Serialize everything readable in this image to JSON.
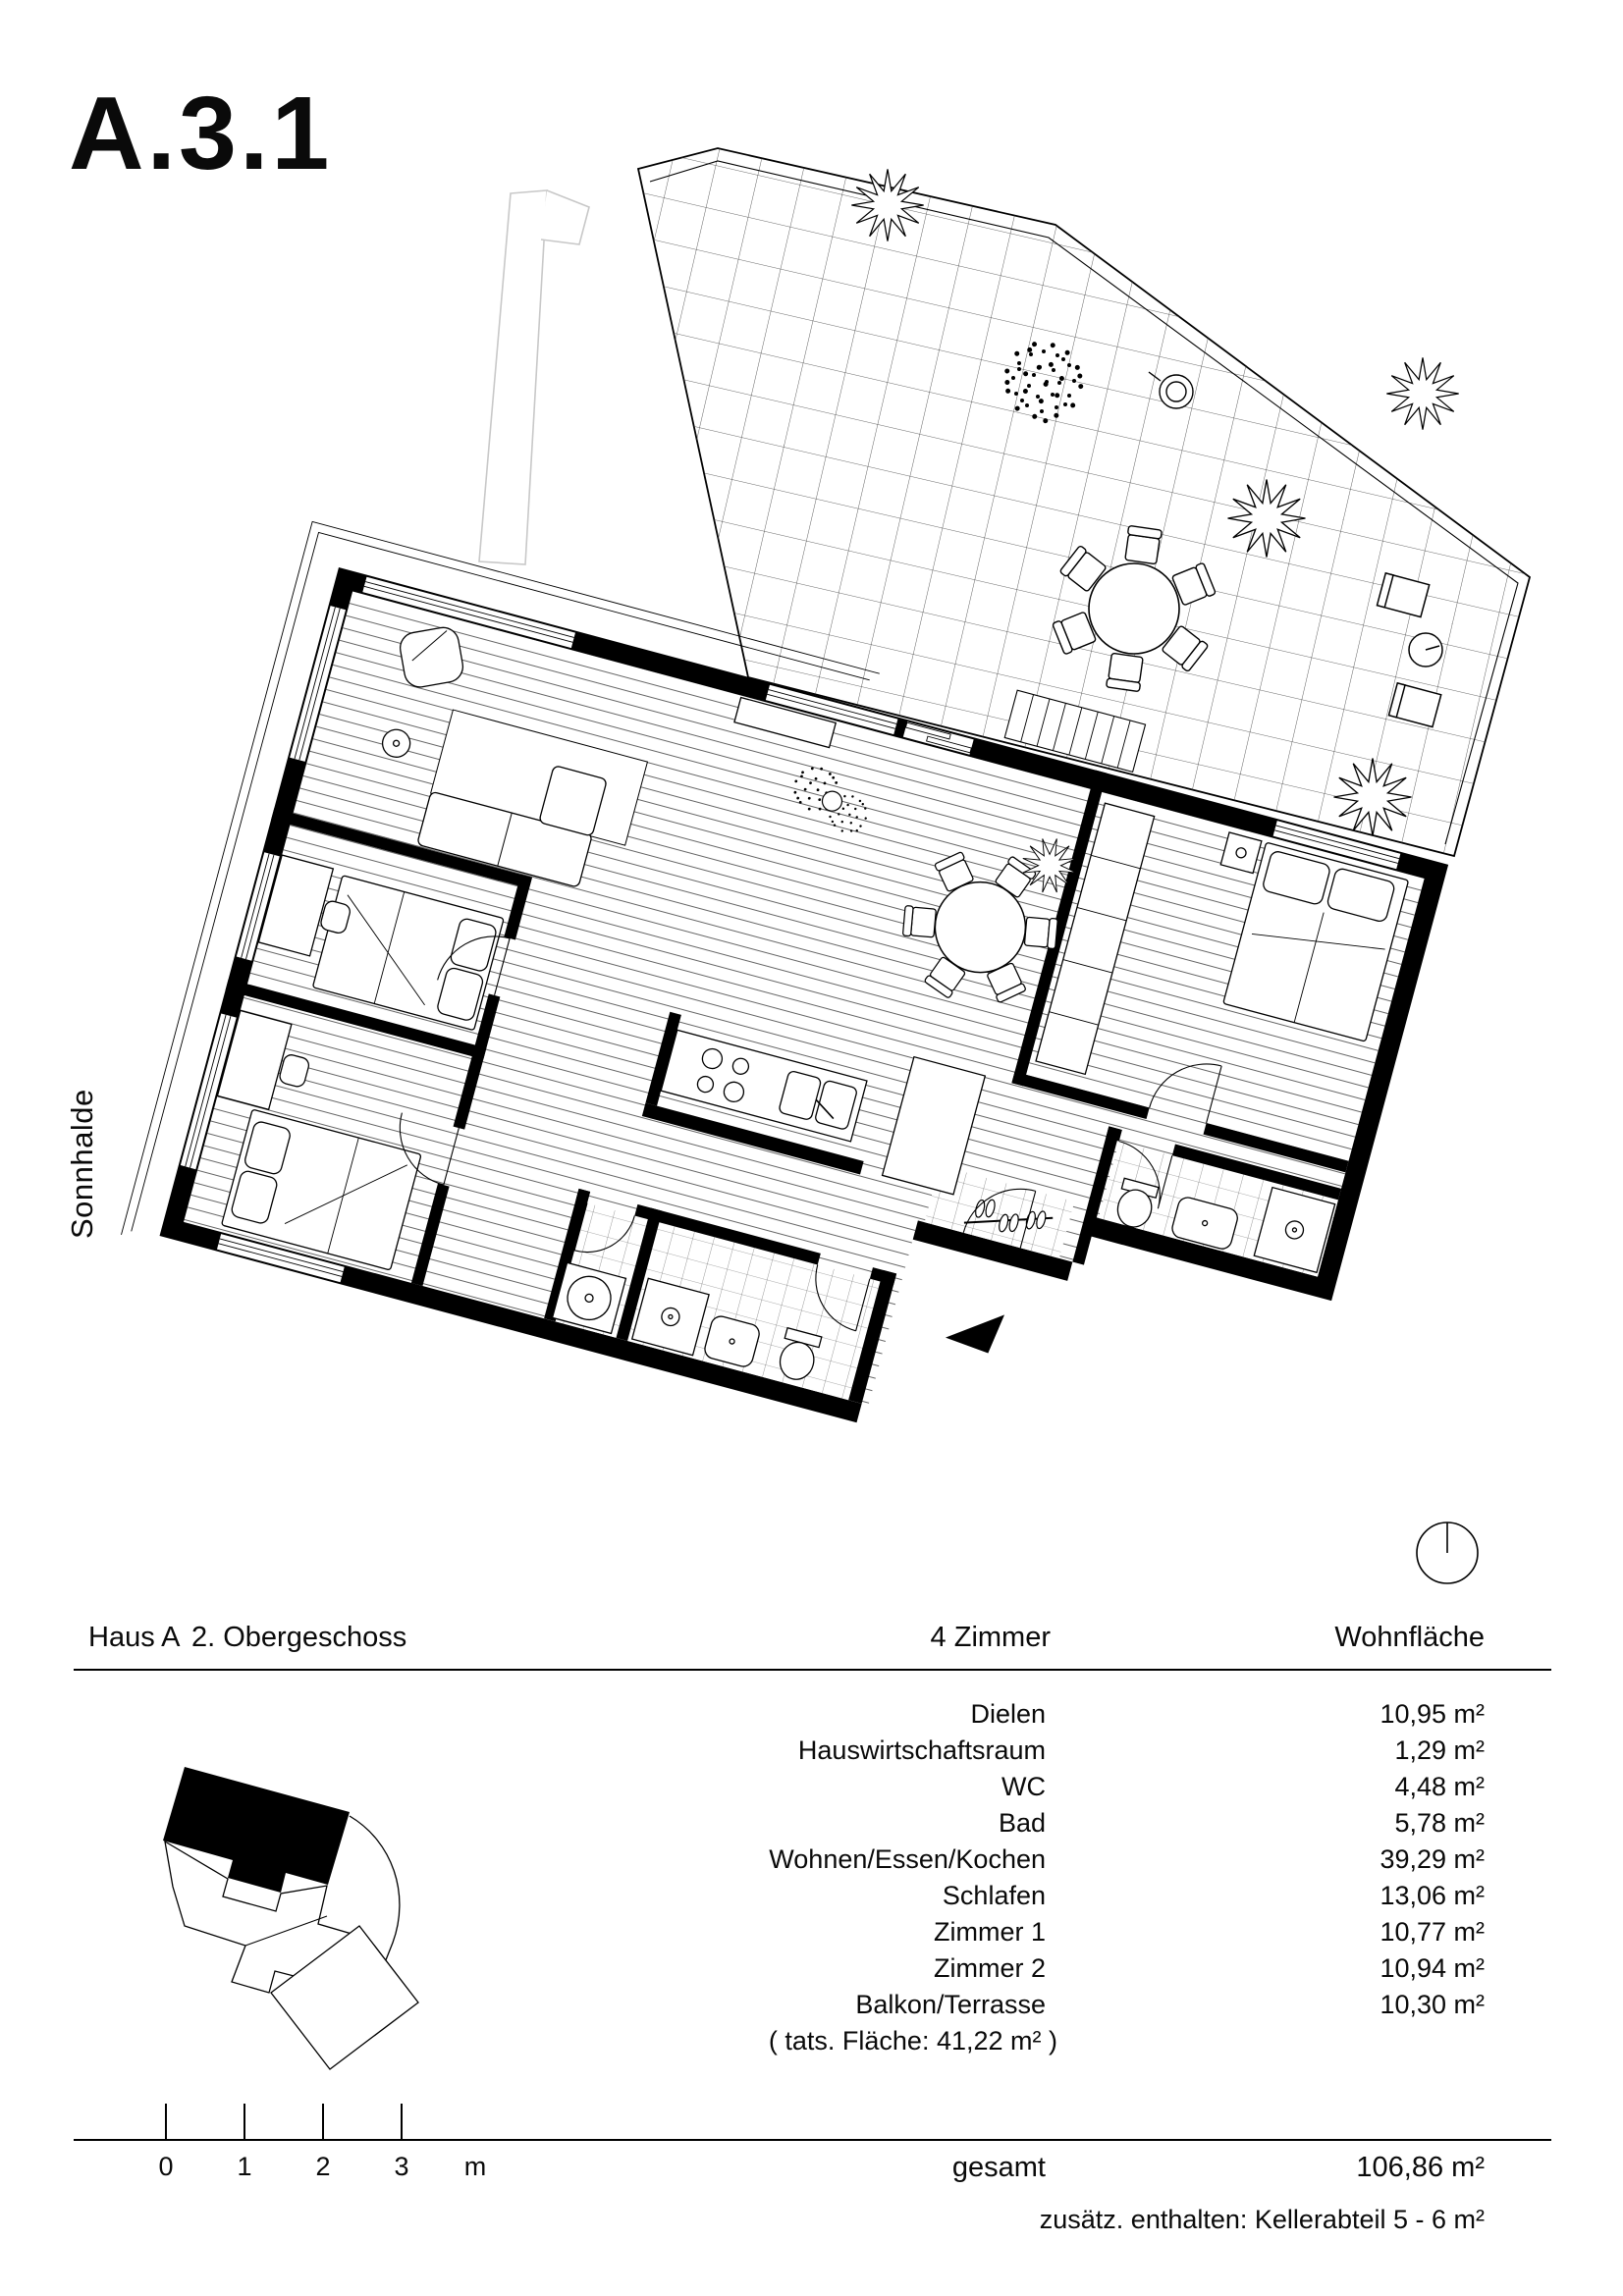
{
  "page": {
    "title": "A.3.1",
    "street_label": "Sonnhalde"
  },
  "table": {
    "header": {
      "house": "Haus A",
      "floor": "2. Obergeschoss",
      "rooms": "4 Zimmer",
      "area": "Wohnfläche"
    },
    "rows": [
      {
        "label": "Dielen",
        "value": "10,95 m²"
      },
      {
        "label": "Hauswirtschaftsraum",
        "value": "1,29 m²"
      },
      {
        "label": "WC",
        "value": "4,48 m²"
      },
      {
        "label": "Bad",
        "value": "5,78 m²"
      },
      {
        "label": "Wohnen/Essen/Kochen",
        "value": "39,29 m²"
      },
      {
        "label": "Schlafen",
        "value": "13,06 m²"
      },
      {
        "label": "Zimmer 1",
        "value": "10,77 m²"
      },
      {
        "label": "Zimmer 2",
        "value": "10,94 m²"
      },
      {
        "label": "Balkon/Terrasse",
        "value": "10,30 m²"
      }
    ],
    "note": "( tats. Fläche: 41,22 m² )",
    "total": {
      "label": "gesamt",
      "value": "106,86 m²"
    },
    "extra": "zusätz. enthalten: Kellerabteil 5 - 6 m²"
  },
  "scalebar": {
    "ticks": [
      "0",
      "1",
      "2",
      "3"
    ],
    "unit": "m"
  },
  "icons": {
    "north_indicator": "circle-with-north-line",
    "entry_arrow": "solid-triangle",
    "key_plan": "site-plan-with-highlighted-building"
  },
  "colors": {
    "ink": "#000000",
    "faint_shaft": "#c8c8c8",
    "paper": "#ffffff"
  }
}
